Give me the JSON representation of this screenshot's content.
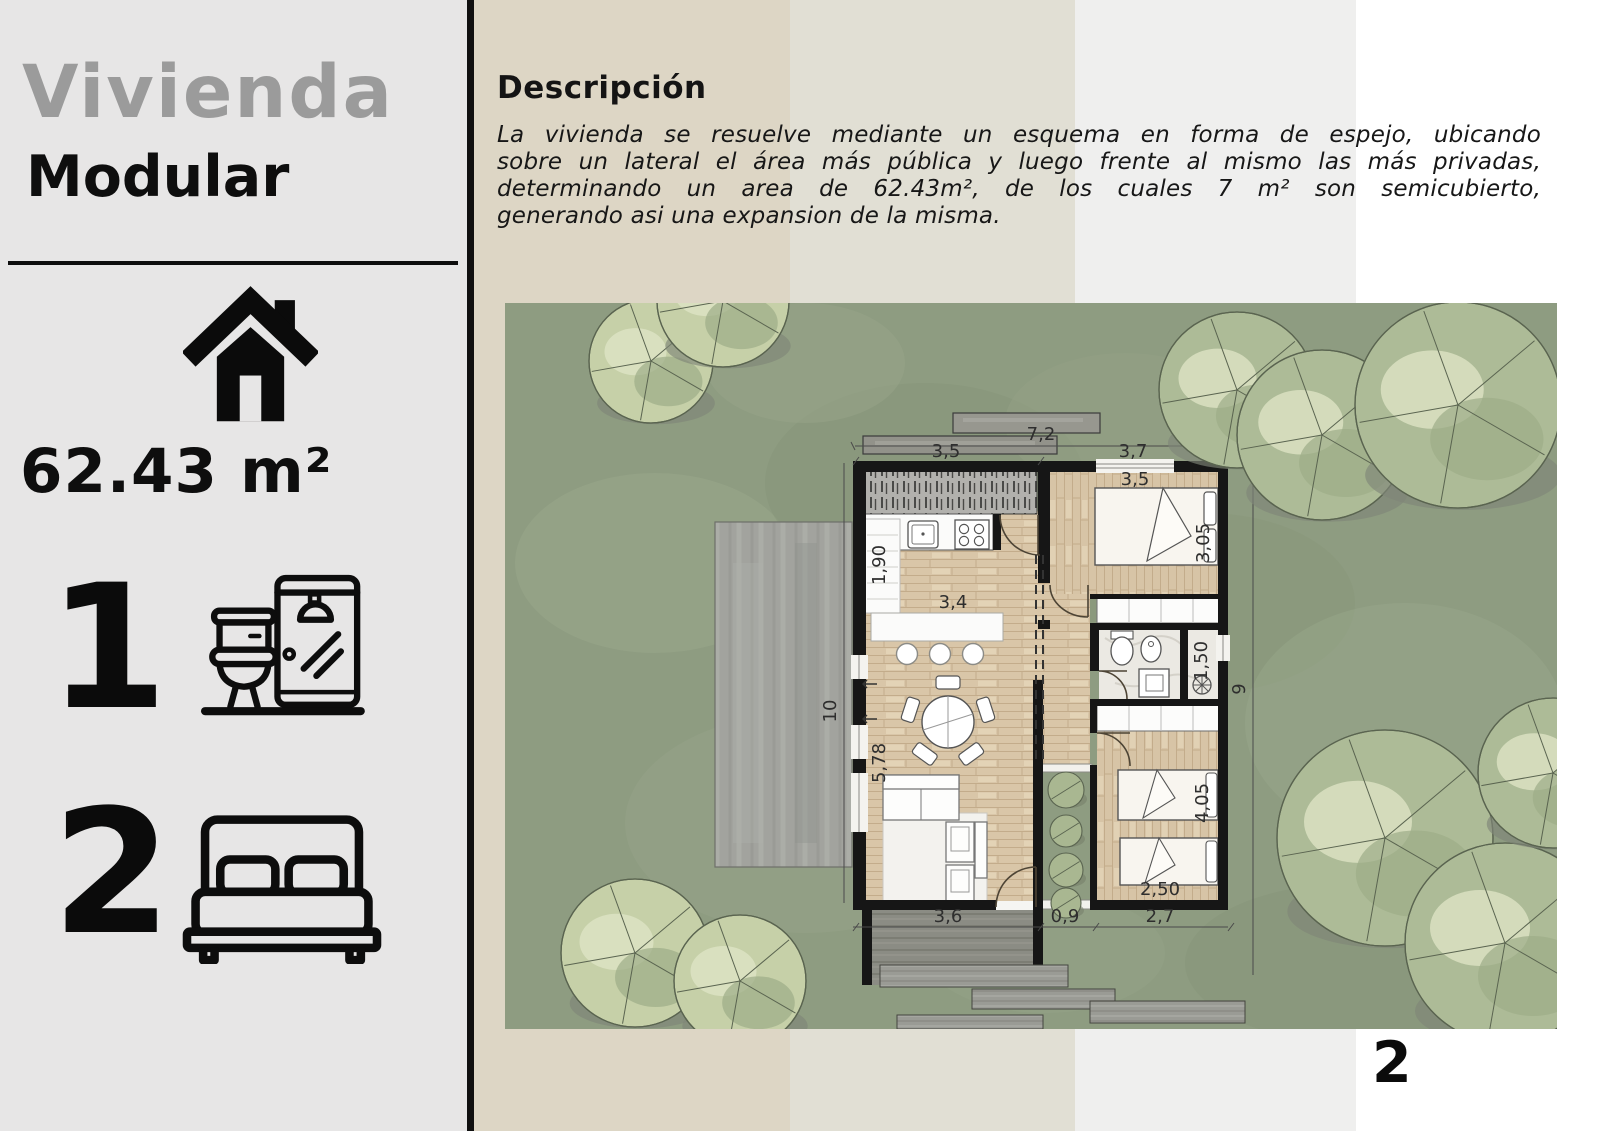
{
  "left_panel": {
    "title": "Vivienda",
    "subtitle": "Modular",
    "area_label": "62.43 m²",
    "bathrooms_count": "1",
    "bedrooms_count": "2",
    "icons": {
      "area": "house-icon",
      "bathrooms": "toilet-shower-icon",
      "bedrooms": "double-bed-icon"
    }
  },
  "description": {
    "heading": "Descripción",
    "lines": [
      "La vivienda se resuelve mediante un esquema en forma de espejo, ubicando",
      "sobre un lateral el área más pública y luego frente al mismo las más privadas,",
      "determinando un area de 62.43m², de los cuales 7 m² son semicubierto,",
      "generando asi una expansion de la misma."
    ]
  },
  "plan": {
    "dims": {
      "total_width": "7,2",
      "left_width": "3,5",
      "right_width": "3,7",
      "bedroom1_width": "3,5",
      "kitchen_depth": "1,90",
      "kitchen_width": "3,4",
      "bedroom1_depth": "3,05",
      "shower_width": "1,50",
      "site_left": "10",
      "site_right": "9",
      "living_depth": "5,78",
      "bedroom2_depth": "4,05",
      "bed_width": "2,50",
      "deck_width": "3,6",
      "patio_width": "0,9",
      "bedroom2_width": "2,7"
    }
  },
  "page_number": "2",
  "colors": {
    "left_bg": "#e7e6e6",
    "stripe_beige": "#ddd6c5",
    "stripe_beige2": "#e1dfd4",
    "stripe_gray": "#efefee",
    "stripe_white": "#ffffff",
    "plan_green": "#8e9c81",
    "wall": "#161616",
    "wood_floor": "#d9c6a8",
    "title_gray": "#9b9b9b",
    "text": "#171717"
  }
}
